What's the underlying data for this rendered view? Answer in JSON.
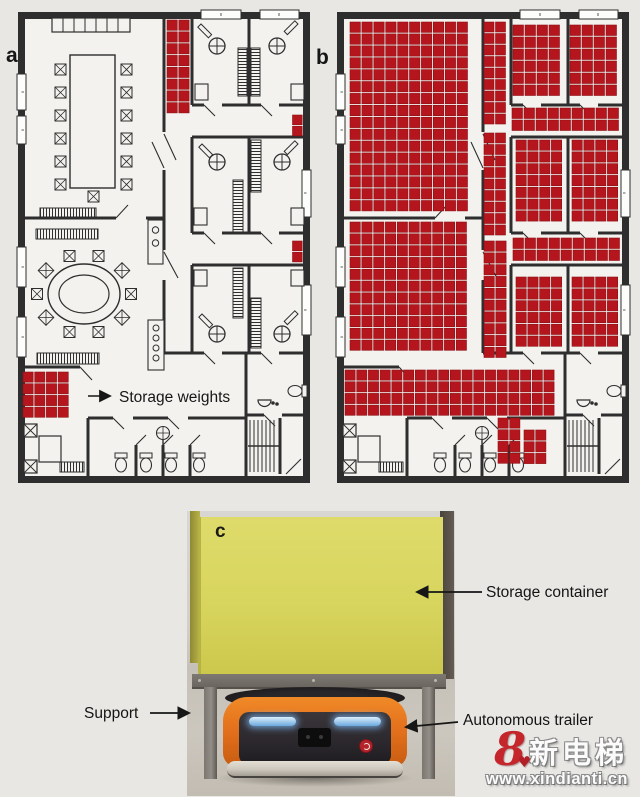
{
  "figure": {
    "panels": {
      "a": {
        "label": "a"
      },
      "b": {
        "label": "b"
      },
      "c": {
        "label": "c"
      }
    },
    "annotations": {
      "storage_weights": "Storage weights",
      "storage_container": "Storage container",
      "support": "Support",
      "autonomous_trailer": "Autonomous trailer"
    },
    "watermark": {
      "logo_glyph": "8",
      "heart_glyph": "♥",
      "brand": "新电梯",
      "url": "www.xindianti.cn"
    },
    "colors": {
      "storage_red": "#b5151c",
      "storage_red_border": "#8e0f15",
      "wall_dark": "#2e2e2e",
      "floor_light": "#f3f2ef",
      "page_bg": "#e8e7e4",
      "container_yellow": "#d8d55e",
      "robot_orange": "#e4711c",
      "headlight_blue": "#a8d4f2",
      "watermark_red": "#c4262c"
    },
    "storage_grids": {
      "a": [
        {
          "x": 167,
          "y": 20,
          "cols": 2,
          "rows": 8,
          "cell": 11.8
        },
        {
          "x": 292.5,
          "y": 115,
          "cols": 1,
          "rows": 2,
          "cell": 11.2
        },
        {
          "x": 292.5,
          "y": 241,
          "cols": 1,
          "rows": 2,
          "cell": 11.2
        },
        {
          "x": 23,
          "y": 372,
          "cols": 4,
          "rows": 4,
          "cell": 11.7
        }
      ],
      "b": [
        {
          "x": 350,
          "y": 22,
          "cols": 10,
          "rows": 16,
          "cell": 11.9
        },
        {
          "x": 350,
          "y": 222,
          "cols": 10,
          "rows": 11,
          "cell": 11.8
        },
        {
          "x": 484,
          "y": 22,
          "cols": 2,
          "rows": 9,
          "cell": 11.5
        },
        {
          "x": 484,
          "y": 133,
          "cols": 2,
          "rows": 9,
          "cell": 11.5
        },
        {
          "x": 484,
          "y": 241,
          "cols": 2,
          "rows": 10,
          "cell": 11.8
        },
        {
          "x": 513,
          "y": 25,
          "cols": 4,
          "rows": 6,
          "cell": 12
        },
        {
          "x": 570,
          "y": 25,
          "cols": 4,
          "rows": 6,
          "cell": 12
        },
        {
          "x": 512,
          "y": 108,
          "cols": 9,
          "rows": 2,
          "cell": 12
        },
        {
          "x": 516,
          "y": 140,
          "cols": 4,
          "rows": 7,
          "cell": 11.8
        },
        {
          "x": 572,
          "y": 140,
          "cols": 4,
          "rows": 7,
          "cell": 11.8
        },
        {
          "x": 513,
          "y": 238,
          "cols": 9,
          "rows": 2,
          "cell": 12
        },
        {
          "x": 516,
          "y": 277,
          "cols": 4,
          "rows": 6,
          "cell": 11.8
        },
        {
          "x": 572,
          "y": 277,
          "cols": 4,
          "rows": 6,
          "cell": 11.8
        },
        {
          "x": 345,
          "y": 370,
          "cols": 18,
          "rows": 4,
          "cell": 11.7
        },
        {
          "x": 498,
          "y": 418,
          "cols": 2,
          "rows": 4,
          "cell": 11.7
        },
        {
          "x": 524,
          "y": 430,
          "cols": 2,
          "rows": 3,
          "cell": 11.7
        }
      ]
    }
  }
}
